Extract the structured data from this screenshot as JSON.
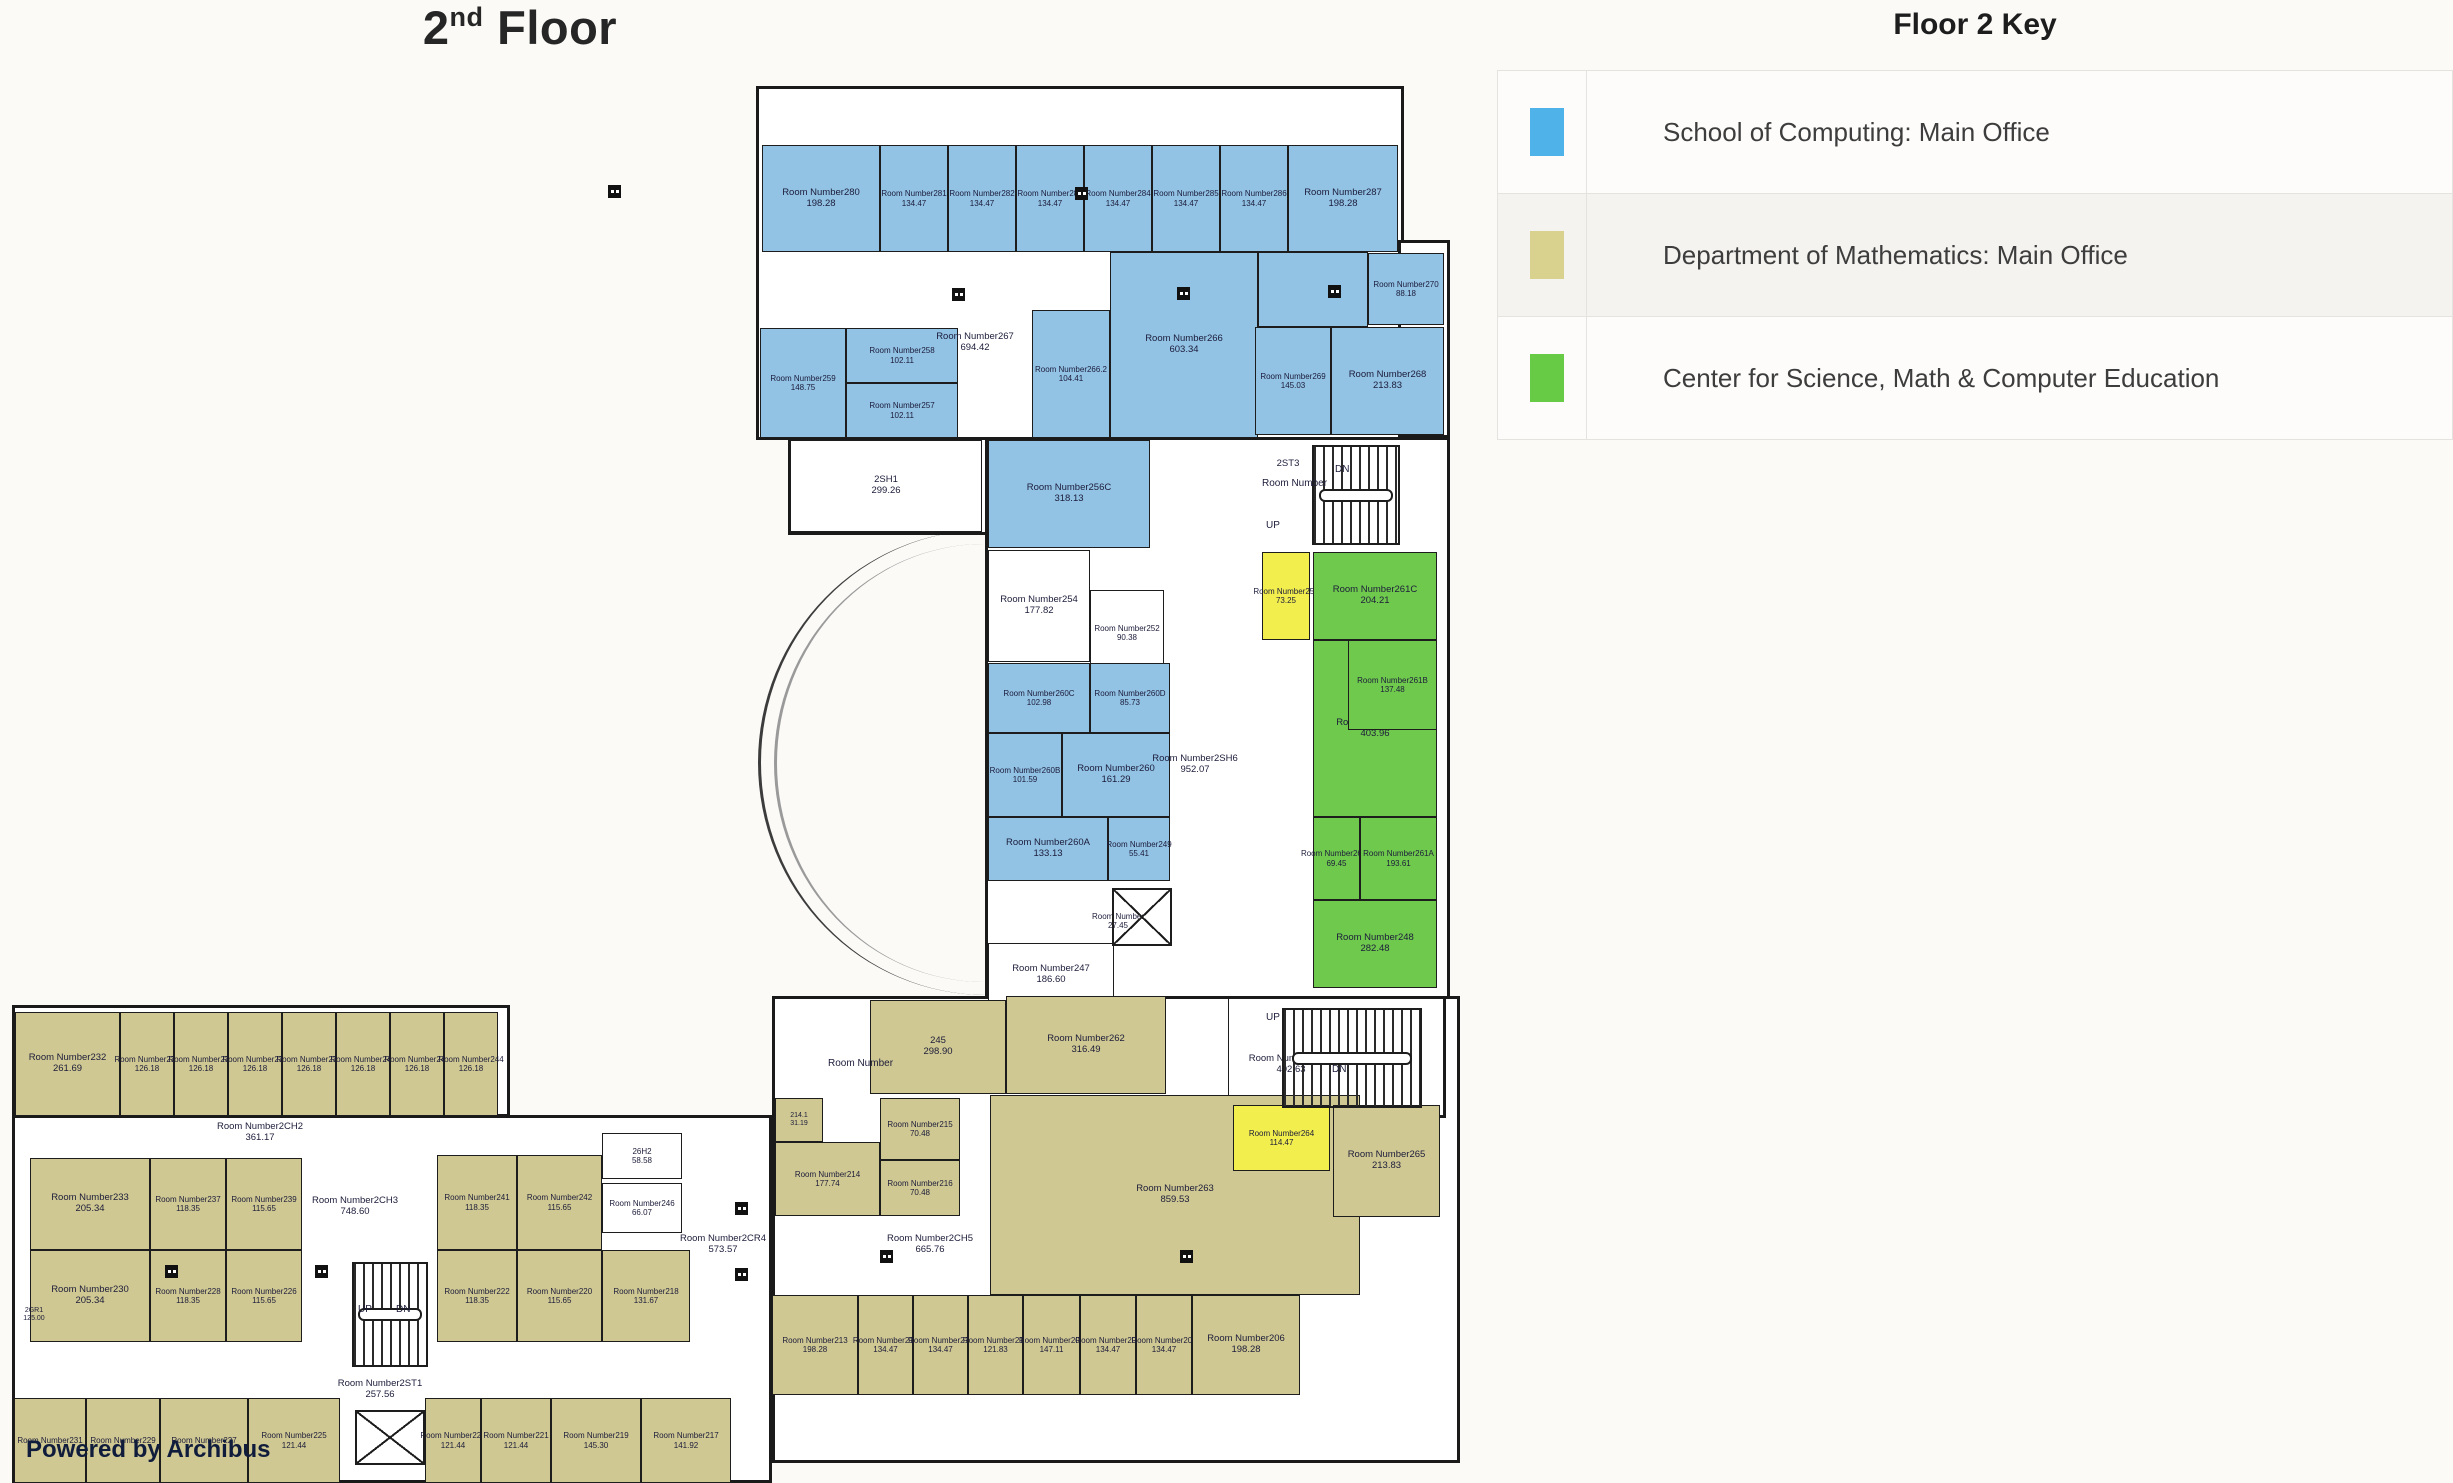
{
  "page": {
    "title_num": "2",
    "title_sup": "nd",
    "title_rest": " Floor",
    "powered_by": "Powered by Archibus",
    "room_label_prefix": "Room Number"
  },
  "legend": {
    "title": "Floor 2 Key",
    "rows": [
      {
        "color": "#4fb2e8",
        "label": "School of Computing: Main Office"
      },
      {
        "color": "#d8d28e",
        "label": "Department of Mathematics: Main Office"
      },
      {
        "color": "#68cb45",
        "label": "Center for Science, Math & Computer Education"
      }
    ]
  },
  "colors": {
    "blue": "#92c2e4",
    "tan": "#cfc892",
    "green": "#6fc94d",
    "yellow": "#f2ee4d",
    "white": "#ffffff",
    "wall": "#1d1d1d",
    "text": "#1c1c3a"
  },
  "plan": {
    "wings": [
      {
        "x": 756,
        "y": 86,
        "w": 648,
        "h": 354
      },
      {
        "x": 1398,
        "y": 240,
        "w": 52,
        "h": 198
      },
      {
        "x": 985,
        "y": 437,
        "w": 465,
        "h": 573
      },
      {
        "x": 788,
        "y": 437,
        "w": 200,
        "h": 98
      },
      {
        "x": 772,
        "y": 996,
        "w": 688,
        "h": 467
      },
      {
        "x": 1228,
        "y": 996,
        "w": 218,
        "h": 122
      },
      {
        "x": 12,
        "y": 1005,
        "w": 498,
        "h": 112
      },
      {
        "x": 12,
        "y": 1115,
        "w": 760,
        "h": 368
      }
    ],
    "rooms": [
      {
        "id": "280",
        "area": "198.28",
        "x": 762,
        "y": 145,
        "w": 118,
        "h": 107,
        "f": "blue"
      },
      {
        "id": "281",
        "area": "134.47",
        "x": 880,
        "y": 145,
        "w": 68,
        "h": 107,
        "f": "blue",
        "fs": "fs8"
      },
      {
        "id": "282",
        "area": "134.47",
        "x": 948,
        "y": 145,
        "w": 68,
        "h": 107,
        "f": "blue",
        "fs": "fs8"
      },
      {
        "id": "283",
        "area": "134.47",
        "x": 1016,
        "y": 145,
        "w": 68,
        "h": 107,
        "f": "blue",
        "fs": "fs8"
      },
      {
        "id": "284",
        "area": "134.47",
        "x": 1084,
        "y": 145,
        "w": 68,
        "h": 107,
        "f": "blue",
        "fs": "fs8"
      },
      {
        "id": "285",
        "area": "134.47",
        "x": 1152,
        "y": 145,
        "w": 68,
        "h": 107,
        "f": "blue",
        "fs": "fs8"
      },
      {
        "id": "286",
        "area": "134.47",
        "x": 1220,
        "y": 145,
        "w": 68,
        "h": 107,
        "f": "blue",
        "fs": "fs8"
      },
      {
        "id": "287",
        "area": "198.28",
        "x": 1288,
        "y": 145,
        "w": 110,
        "h": 107,
        "f": "blue"
      },
      {
        "id": "259",
        "area": "148.75",
        "x": 760,
        "y": 328,
        "w": 86,
        "h": 110,
        "f": "blue",
        "fs": "fs8"
      },
      {
        "id": "258",
        "area": "102.11",
        "x": 846,
        "y": 328,
        "w": 112,
        "h": 55,
        "f": "blue",
        "fs": "fs8"
      },
      {
        "id": "257",
        "area": "102.11",
        "x": 846,
        "y": 383,
        "w": 112,
        "h": 55,
        "f": "blue",
        "fs": "fs8"
      },
      {
        "id": "267",
        "area": "694.42",
        "x": 930,
        "y": 318,
        "w": 90,
        "h": 50,
        "f": "white",
        "nb": true
      },
      {
        "id": "266.2",
        "area": "104.41",
        "x": 1032,
        "y": 310,
        "w": 78,
        "h": 128,
        "f": "blue",
        "fs": "fs8"
      },
      {
        "id": "266",
        "area": "603.34",
        "x": 1110,
        "y": 252,
        "w": 148,
        "h": 186,
        "f": "blue"
      },
      {
        "id": "",
        "area": "",
        "x": 1258,
        "y": 252,
        "w": 110,
        "h": 75,
        "f": "blue"
      },
      {
        "id": "270",
        "area": "88.18",
        "x": 1368,
        "y": 253,
        "w": 76,
        "h": 72,
        "f": "blue",
        "fs": "fs8"
      },
      {
        "id": "269",
        "area": "145.03",
        "x": 1255,
        "y": 327,
        "w": 76,
        "h": 108,
        "f": "blue",
        "fs": "fs8"
      },
      {
        "id": "268",
        "area": "213.83",
        "x": 1331,
        "y": 327,
        "w": 113,
        "h": 108,
        "f": "blue"
      },
      {
        "id": "2SH1",
        "area": "299.26",
        "x": 790,
        "y": 440,
        "w": 192,
        "h": 92,
        "f": "white",
        "np": true
      },
      {
        "id": "256C",
        "area": "318.13",
        "x": 988,
        "y": 440,
        "w": 162,
        "h": 108,
        "f": "blue"
      },
      {
        "id": "2ST3",
        "area": "",
        "x": 1268,
        "y": 452,
        "w": 40,
        "h": 24,
        "f": "white",
        "nb": true,
        "np": true
      },
      {
        "id": "254",
        "area": "177.82",
        "x": 988,
        "y": 550,
        "w": 102,
        "h": 112,
        "f": "white"
      },
      {
        "id": "252",
        "area": "90.38",
        "x": 1090,
        "y": 590,
        "w": 74,
        "h": 86,
        "f": "white",
        "fs": "fs8"
      },
      {
        "id": "253",
        "area": "73.25",
        "x": 1262,
        "y": 552,
        "w": 48,
        "h": 88,
        "f": "yellow",
        "fs": "fs8"
      },
      {
        "id": "261C",
        "area": "204.21",
        "x": 1313,
        "y": 552,
        "w": 124,
        "h": 88,
        "f": "green"
      },
      {
        "id": "261",
        "area": "403.96",
        "x": 1313,
        "y": 640,
        "w": 124,
        "h": 177,
        "f": "green"
      },
      {
        "id": "261B",
        "area": "137.48",
        "x": 1348,
        "y": 640,
        "w": 89,
        "h": 90,
        "f": "green",
        "fs": "fs8"
      },
      {
        "id": "261D",
        "area": "69.45",
        "x": 1313,
        "y": 817,
        "w": 47,
        "h": 83,
        "f": "green",
        "fs": "fs8"
      },
      {
        "id": "261A",
        "area": "193.61",
        "x": 1360,
        "y": 817,
        "w": 77,
        "h": 83,
        "f": "green",
        "fs": "fs8"
      },
      {
        "id": "248",
        "area": "282.48",
        "x": 1313,
        "y": 900,
        "w": 124,
        "h": 88,
        "f": "green"
      },
      {
        "id": "260C",
        "area": "102.98",
        "x": 988,
        "y": 663,
        "w": 102,
        "h": 70,
        "f": "blue",
        "fs": "fs8"
      },
      {
        "id": "260D",
        "area": "85.73",
        "x": 1090,
        "y": 663,
        "w": 80,
        "h": 70,
        "f": "blue",
        "fs": "fs8"
      },
      {
        "id": "260B",
        "area": "101.59",
        "x": 988,
        "y": 733,
        "w": 74,
        "h": 84,
        "f": "blue",
        "fs": "fs8"
      },
      {
        "id": "260",
        "area": "161.29",
        "x": 1062,
        "y": 733,
        "w": 108,
        "h": 84,
        "f": "blue"
      },
      {
        "id": "260A",
        "area": "133.13",
        "x": 988,
        "y": 817,
        "w": 120,
        "h": 64,
        "f": "blue"
      },
      {
        "id": "249",
        "area": "55.41",
        "x": 1108,
        "y": 817,
        "w": 62,
        "h": 64,
        "f": "blue",
        "fs": "fs8"
      },
      {
        "id": "",
        "area": "27.45",
        "x": 1078,
        "y": 908,
        "w": 80,
        "h": 26,
        "f": "white",
        "nb": true,
        "fs": "fs8"
      },
      {
        "id": "247",
        "area": "186.60",
        "x": 988,
        "y": 943,
        "w": 126,
        "h": 64,
        "f": "white"
      },
      {
        "id": "2SH6",
        "area": "952.07",
        "x": 1152,
        "y": 750,
        "w": 86,
        "h": 30,
        "f": "white",
        "nb": true
      },
      {
        "id": "",
        "area": "",
        "x": 1228,
        "y": 998,
        "w": 216,
        "h": 118,
        "f": "white"
      },
      {
        "id": "2ST2",
        "area": "402.63",
        "x": 1236,
        "y": 1048,
        "w": 110,
        "h": 34,
        "f": "white",
        "nb": true
      },
      {
        "id": "245",
        "area": "298.90",
        "x": 870,
        "y": 1000,
        "w": 136,
        "h": 94,
        "f": "tan",
        "np": true
      },
      {
        "id": "262",
        "area": "316.49",
        "x": 1006,
        "y": 996,
        "w": 160,
        "h": 98,
        "f": "tan"
      },
      {
        "id": "214.1",
        "area": "31.19",
        "x": 775,
        "y": 1098,
        "w": 48,
        "h": 44,
        "f": "tan",
        "np": true,
        "fs": "fs7"
      },
      {
        "id": "215",
        "area": "70.48",
        "x": 880,
        "y": 1098,
        "w": 80,
        "h": 62,
        "f": "tan",
        "fs": "fs8"
      },
      {
        "id": "214",
        "area": "177.74",
        "x": 775,
        "y": 1142,
        "w": 105,
        "h": 74,
        "f": "tan",
        "fs": "fs8"
      },
      {
        "id": "216",
        "area": "70.48",
        "x": 880,
        "y": 1160,
        "w": 80,
        "h": 56,
        "f": "tan",
        "fs": "fs8"
      },
      {
        "id": "2CH5",
        "area": "665.76",
        "x": 880,
        "y": 1228,
        "w": 100,
        "h": 34,
        "f": "white",
        "nb": true
      },
      {
        "id": "263",
        "area": "859.53",
        "x": 990,
        "y": 1095,
        "w": 370,
        "h": 200,
        "f": "tan"
      },
      {
        "id": "264",
        "area": "114.47",
        "x": 1233,
        "y": 1105,
        "w": 97,
        "h": 66,
        "f": "yellow",
        "fs": "fs8"
      },
      {
        "id": "265",
        "area": "213.83",
        "x": 1333,
        "y": 1105,
        "w": 107,
        "h": 112,
        "f": "tan"
      },
      {
        "id": "213",
        "area": "198.28",
        "x": 772,
        "y": 1295,
        "w": 86,
        "h": 100,
        "f": "tan",
        "fs": "fs8"
      },
      {
        "id": "212",
        "area": "134.47",
        "x": 858,
        "y": 1295,
        "w": 55,
        "h": 100,
        "f": "tan",
        "fs": "fs8"
      },
      {
        "id": "211",
        "area": "134.47",
        "x": 913,
        "y": 1295,
        "w": 55,
        "h": 100,
        "f": "tan",
        "fs": "fs8"
      },
      {
        "id": "210",
        "area": "121.83",
        "x": 968,
        "y": 1295,
        "w": 55,
        "h": 100,
        "f": "tan",
        "fs": "fs8"
      },
      {
        "id": "209",
        "area": "147.11",
        "x": 1023,
        "y": 1295,
        "w": 57,
        "h": 100,
        "f": "tan",
        "fs": "fs8"
      },
      {
        "id": "208",
        "area": "134.47",
        "x": 1080,
        "y": 1295,
        "w": 56,
        "h": 100,
        "f": "tan",
        "fs": "fs8"
      },
      {
        "id": "207",
        "area": "134.47",
        "x": 1136,
        "y": 1295,
        "w": 56,
        "h": 100,
        "f": "tan",
        "fs": "fs8"
      },
      {
        "id": "206",
        "area": "198.28",
        "x": 1192,
        "y": 1295,
        "w": 108,
        "h": 100,
        "f": "tan"
      },
      {
        "id": "232",
        "area": "261.69",
        "x": 15,
        "y": 1012,
        "w": 105,
        "h": 104,
        "f": "tan"
      },
      {
        "id": "234",
        "area": "126.18",
        "x": 120,
        "y": 1012,
        "w": 54,
        "h": 104,
        "f": "tan",
        "fs": "fs8"
      },
      {
        "id": "235",
        "area": "126.18",
        "x": 174,
        "y": 1012,
        "w": 54,
        "h": 104,
        "f": "tan",
        "fs": "fs8"
      },
      {
        "id": "236",
        "area": "126.18",
        "x": 228,
        "y": 1012,
        "w": 54,
        "h": 104,
        "f": "tan",
        "fs": "fs8"
      },
      {
        "id": "238",
        "area": "126.18",
        "x": 282,
        "y": 1012,
        "w": 54,
        "h": 104,
        "f": "tan",
        "fs": "fs8"
      },
      {
        "id": "240",
        "area": "126.18",
        "x": 336,
        "y": 1012,
        "w": 54,
        "h": 104,
        "f": "tan",
        "fs": "fs8"
      },
      {
        "id": "243",
        "area": "126.18",
        "x": 390,
        "y": 1012,
        "w": 54,
        "h": 104,
        "f": "tan",
        "fs": "fs8"
      },
      {
        "id": "244",
        "area": "126.18",
        "x": 444,
        "y": 1012,
        "w": 54,
        "h": 104,
        "f": "tan",
        "fs": "fs8"
      },
      {
        "id": "2CH2",
        "area": "361.17",
        "x": 200,
        "y": 1116,
        "w": 120,
        "h": 34,
        "f": "white",
        "nb": true
      },
      {
        "id": "233",
        "area": "205.34",
        "x": 30,
        "y": 1158,
        "w": 120,
        "h": 92,
        "f": "tan"
      },
      {
        "id": "237",
        "area": "118.35",
        "x": 150,
        "y": 1158,
        "w": 76,
        "h": 92,
        "f": "tan",
        "fs": "fs8"
      },
      {
        "id": "239",
        "area": "115.65",
        "x": 226,
        "y": 1158,
        "w": 76,
        "h": 92,
        "f": "tan",
        "fs": "fs8"
      },
      {
        "id": "241",
        "area": "118.35",
        "x": 437,
        "y": 1155,
        "w": 80,
        "h": 95,
        "f": "tan",
        "fs": "fs8"
      },
      {
        "id": "242",
        "area": "115.65",
        "x": 517,
        "y": 1155,
        "w": 85,
        "h": 95,
        "f": "tan",
        "fs": "fs8"
      },
      {
        "id": "26H2",
        "area": "58.58",
        "x": 602,
        "y": 1133,
        "w": 80,
        "h": 46,
        "f": "white",
        "np": true,
        "fs": "fs8"
      },
      {
        "id": "246",
        "area": "66.07",
        "x": 602,
        "y": 1183,
        "w": 80,
        "h": 50,
        "f": "white",
        "fs": "fs8"
      },
      {
        "id": "2CR4",
        "area": "573.57",
        "x": 680,
        "y": 1228,
        "w": 86,
        "h": 34,
        "f": "white",
        "nb": true
      },
      {
        "id": "2CH3",
        "area": "748.60",
        "x": 300,
        "y": 1190,
        "w": 110,
        "h": 34,
        "f": "white",
        "nb": true
      },
      {
        "id": "230",
        "area": "205.34",
        "x": 30,
        "y": 1250,
        "w": 120,
        "h": 92,
        "f": "tan"
      },
      {
        "id": "228",
        "area": "118.35",
        "x": 150,
        "y": 1250,
        "w": 76,
        "h": 92,
        "f": "tan",
        "fs": "fs8"
      },
      {
        "id": "226",
        "area": "115.65",
        "x": 226,
        "y": 1250,
        "w": 76,
        "h": 92,
        "f": "tan",
        "fs": "fs8"
      },
      {
        "id": "222",
        "area": "118.35",
        "x": 437,
        "y": 1250,
        "w": 80,
        "h": 92,
        "f": "tan",
        "fs": "fs8"
      },
      {
        "id": "220",
        "area": "115.65",
        "x": 517,
        "y": 1250,
        "w": 85,
        "h": 92,
        "f": "tan",
        "fs": "fs8"
      },
      {
        "id": "218",
        "area": "131.67",
        "x": 602,
        "y": 1250,
        "w": 88,
        "h": 92,
        "f": "tan",
        "fs": "fs8"
      },
      {
        "id": "2GR1",
        "area": "125.00",
        "x": 12,
        "y": 1300,
        "w": 44,
        "h": 30,
        "f": "white",
        "nb": true,
        "np": true,
        "fs": "fs7"
      },
      {
        "id": "2ST1",
        "area": "257.56",
        "x": 330,
        "y": 1375,
        "w": 100,
        "h": 30,
        "f": "white",
        "nb": true
      },
      {
        "id": "231",
        "area": "",
        "x": 14,
        "y": 1398,
        "w": 72,
        "h": 85,
        "f": "tan",
        "fs": "fs8"
      },
      {
        "id": "229",
        "area": "",
        "x": 86,
        "y": 1398,
        "w": 74,
        "h": 85,
        "f": "tan",
        "fs": "fs8"
      },
      {
        "id": "227",
        "area": "",
        "x": 160,
        "y": 1398,
        "w": 88,
        "h": 85,
        "f": "tan",
        "fs": "fs8"
      },
      {
        "id": "225",
        "area": "121.44",
        "x": 248,
        "y": 1398,
        "w": 92,
        "h": 85,
        "f": "tan",
        "fs": "fs8"
      },
      {
        "id": "223",
        "area": "121.44",
        "x": 425,
        "y": 1398,
        "w": 56,
        "h": 85,
        "f": "tan",
        "fs": "fs8"
      },
      {
        "id": "221",
        "area": "121.44",
        "x": 481,
        "y": 1398,
        "w": 70,
        "h": 85,
        "f": "tan",
        "fs": "fs8"
      },
      {
        "id": "219",
        "area": "145.30",
        "x": 551,
        "y": 1398,
        "w": 90,
        "h": 85,
        "f": "tan",
        "fs": "fs8"
      },
      {
        "id": "217",
        "area": "141.92",
        "x": 641,
        "y": 1398,
        "w": 90,
        "h": 85,
        "f": "tan",
        "fs": "fs8"
      }
    ],
    "stairs": [
      {
        "x": 1312,
        "y": 445,
        "w": 88,
        "h": 100
      },
      {
        "x": 1282,
        "y": 1008,
        "w": 140,
        "h": 100
      },
      {
        "x": 352,
        "y": 1262,
        "w": 76,
        "h": 105
      }
    ],
    "elevators": [
      {
        "x": 1112,
        "y": 888,
        "w": 60,
        "h": 58
      },
      {
        "x": 355,
        "y": 1410,
        "w": 70,
        "h": 55
      }
    ],
    "texts": [
      {
        "t": "Room Number",
        "x": 828,
        "y": 1058
      },
      {
        "t": "Room Number",
        "x": 1262,
        "y": 478
      },
      {
        "t": "UP",
        "x": 1266,
        "y": 520
      },
      {
        "t": "DN",
        "x": 1335,
        "y": 464
      },
      {
        "t": "UP",
        "x": 1266,
        "y": 1012
      },
      {
        "t": "DN",
        "x": 1332,
        "y": 1064
      },
      {
        "t": "UP",
        "x": 358,
        "y": 1304
      },
      {
        "t": "DN",
        "x": 396,
        "y": 1304
      }
    ],
    "symbols": [
      {
        "x": 952,
        "y": 288
      },
      {
        "x": 1177,
        "y": 287
      },
      {
        "x": 1328,
        "y": 285
      },
      {
        "x": 880,
        "y": 1250
      },
      {
        "x": 1180,
        "y": 1250
      },
      {
        "x": 165,
        "y": 1265
      },
      {
        "x": 315,
        "y": 1265
      },
      {
        "x": 735,
        "y": 1202
      },
      {
        "x": 735,
        "y": 1268
      },
      {
        "x": 608,
        "y": 185
      },
      {
        "x": 1075,
        "y": 187
      }
    ]
  }
}
